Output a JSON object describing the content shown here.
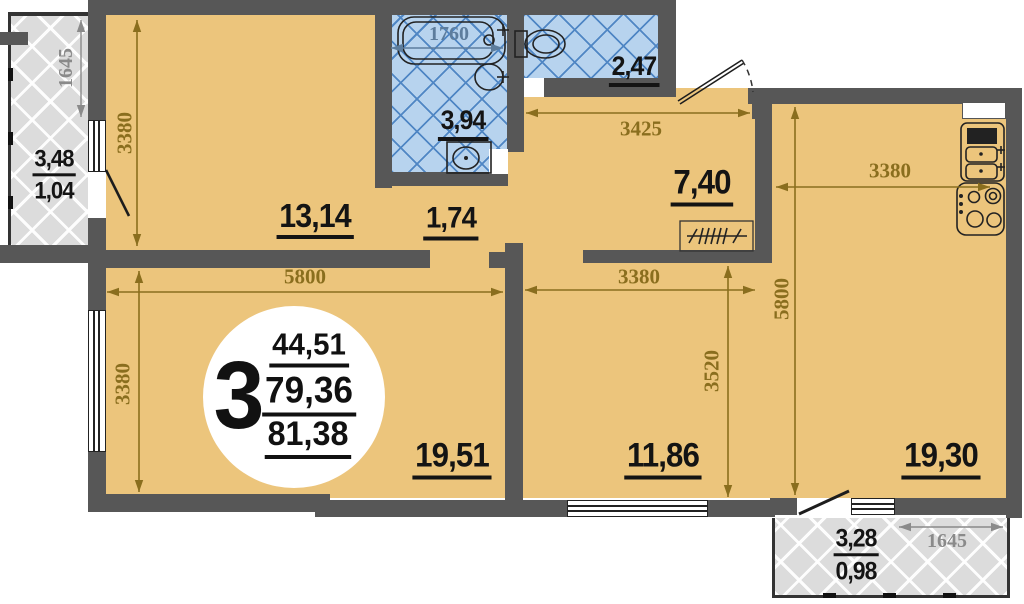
{
  "plan": {
    "summary": {
      "rooms_count": "3",
      "living_area": "44,51",
      "usable_area": "79,36",
      "total_area": "81,38"
    },
    "rooms": {
      "bedroom1": {
        "label": "13,14"
      },
      "hall": {
        "label": "1,74"
      },
      "bathroom": {
        "label": "3,94"
      },
      "wc": {
        "label": "2,47"
      },
      "corridor": {
        "label": "7,40"
      },
      "living_room": {
        "label": "19,51"
      },
      "bedroom2": {
        "label": "11,86"
      },
      "kitchen_room": {
        "label": "19,30"
      },
      "balcony_left": {
        "area": "3,48",
        "area_reduced": "1,04"
      },
      "balcony_bottom": {
        "area": "3,28",
        "area_reduced": "0,98"
      }
    },
    "dimensions": {
      "d3380_bedroom1": "3380",
      "d5800_width": "5800",
      "d3380_living": "3380",
      "d3425_corridor": "3425",
      "d3380_kitchen": "3380",
      "d3380_bedroom2": "3380",
      "d3520_bedroom2": "3520",
      "d5800_kitchen": "5800",
      "d1645_balcony_left": "1645",
      "d1645_balcony_bottom": "1645",
      "d1760_bathtub": "1760"
    },
    "fixtures": [
      "bathtub",
      "washbasin",
      "washing-machine",
      "toilet",
      "kitchen-sink",
      "stove",
      "closet",
      "entrance-door",
      "balcony-door"
    ],
    "colors": {
      "floor": "#ecc57c",
      "wall": "#575757",
      "tile": "#b7d3ee",
      "tile_line": "#4f86c4",
      "balcony": "#dcdcdc",
      "dim": "#8a6e1e",
      "dim_gray": "#8a8a8a",
      "dim_blue": "#5d7d9d"
    }
  }
}
